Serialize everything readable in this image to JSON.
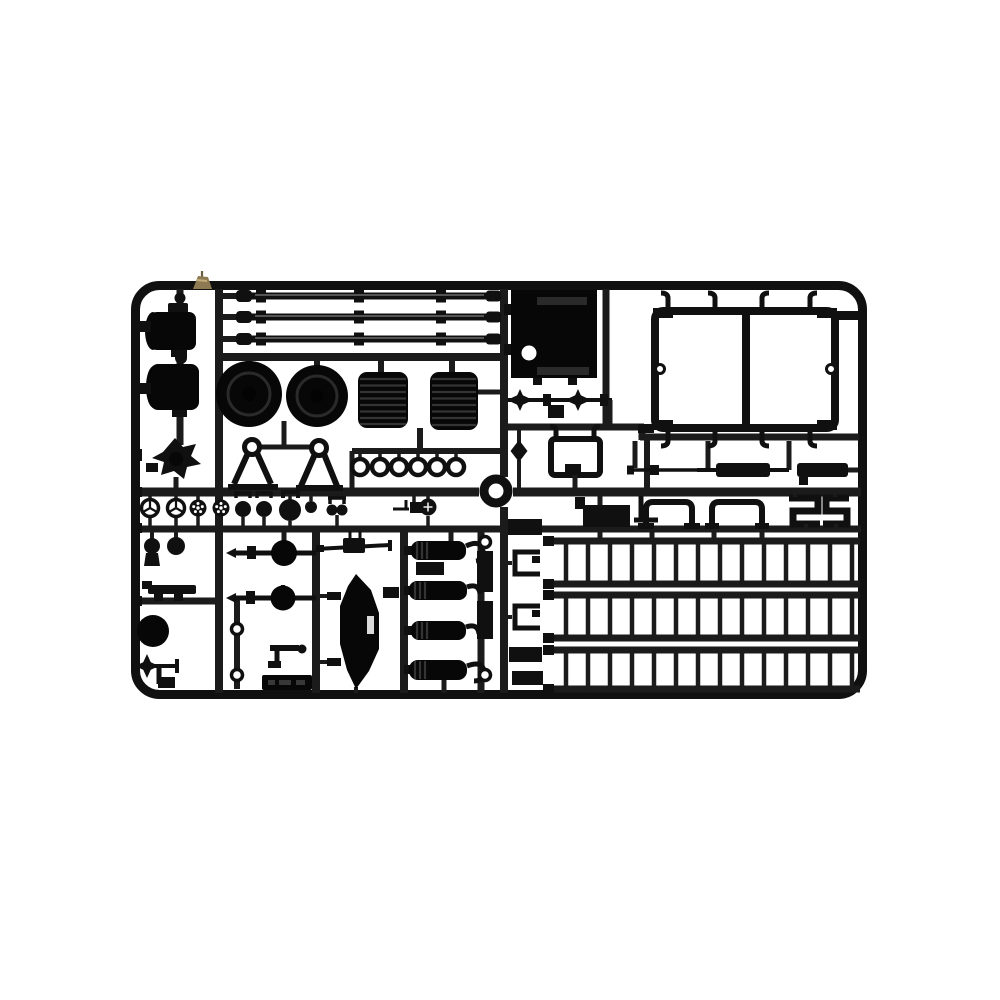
{
  "page": {
    "background_color": "#ffffff"
  },
  "photo": {
    "subject": "Black injection-molded plastic model kit sprue (parts runner) photographed on a white background",
    "object_shape": "landscape rectangular runner frame with rounded corners, internal lattice of runners holding unpainted black polystyrene parts",
    "detail_note": "small tan-colored gate fragment stuck on the top rail near the upper-left corner"
  },
  "palette": {
    "c-bg": "#ffffff",
    "c-runner": "#1b1b1b",
    "c-part": "#101010",
    "c-part-deep": "#070707",
    "c-rib": "#343434",
    "c-sheen": "#8a8a8a",
    "c-tan": "#8d7a52",
    "c-tan-light": "#c3ad7c"
  },
  "parts_inventory": [
    {
      "name": "axle-housing-assembly",
      "qty": 2
    },
    {
      "name": "star-sprocket-coupling",
      "qty": 1
    },
    {
      "name": "long-torsion-rod",
      "qty": 3
    },
    {
      "name": "rubberlike-road-tire",
      "qty": 2
    },
    {
      "name": "ribbed-coil-drum",
      "qty": 2
    },
    {
      "name": "a-frame-support",
      "qty": 2
    },
    {
      "name": "small-eye-ring",
      "qty": 6
    },
    {
      "name": "large-ring",
      "qty": 1
    },
    {
      "name": "hatch-panel-with-hole",
      "qty": 1
    },
    {
      "name": "double-window-frame",
      "qty": 1
    },
    {
      "name": "four-point-star-coupling",
      "qty": 2
    },
    {
      "name": "u-bracket",
      "qty": 1
    },
    {
      "name": "diamond-knob",
      "qty": 1
    },
    {
      "name": "thin-tow-rod",
      "qty": 1
    },
    {
      "name": "flat-bar",
      "qty": 2
    },
    {
      "name": "channel-staple-bracket",
      "qty": 2
    },
    {
      "name": "z-profile-bracket",
      "qty": 2
    },
    {
      "name": "ladder-rack-frame",
      "qty": 3
    },
    {
      "name": "spoked-handwheel",
      "qty": 2
    },
    {
      "name": "perforated-wheel",
      "qty": 3
    },
    {
      "name": "round-knob",
      "qty": 4
    },
    {
      "name": "twin-knob",
      "qty": 1
    },
    {
      "name": "ball-pin",
      "qty": 2
    },
    {
      "name": "leaf-spring-bar",
      "qty": 1
    },
    {
      "name": "solid-disc",
      "qty": 1
    },
    {
      "name": "star-head-pin",
      "qty": 1
    },
    {
      "name": "ball-axle-shaft",
      "qty": 2
    },
    {
      "name": "small-eyelet-washer",
      "qty": 4
    },
    {
      "name": "elbow-bracket",
      "qty": 1
    },
    {
      "name": "embossed-number-plate",
      "qty": 1
    },
    {
      "name": "gun-axle-rod",
      "qty": 1
    },
    {
      "name": "hull-shield-blade",
      "qty": 1
    },
    {
      "name": "tank-cylinder",
      "qty": 4
    },
    {
      "name": "clip-bracket",
      "qty": 2
    },
    {
      "name": "rectangular-block-part",
      "qty": 6
    }
  ]
}
